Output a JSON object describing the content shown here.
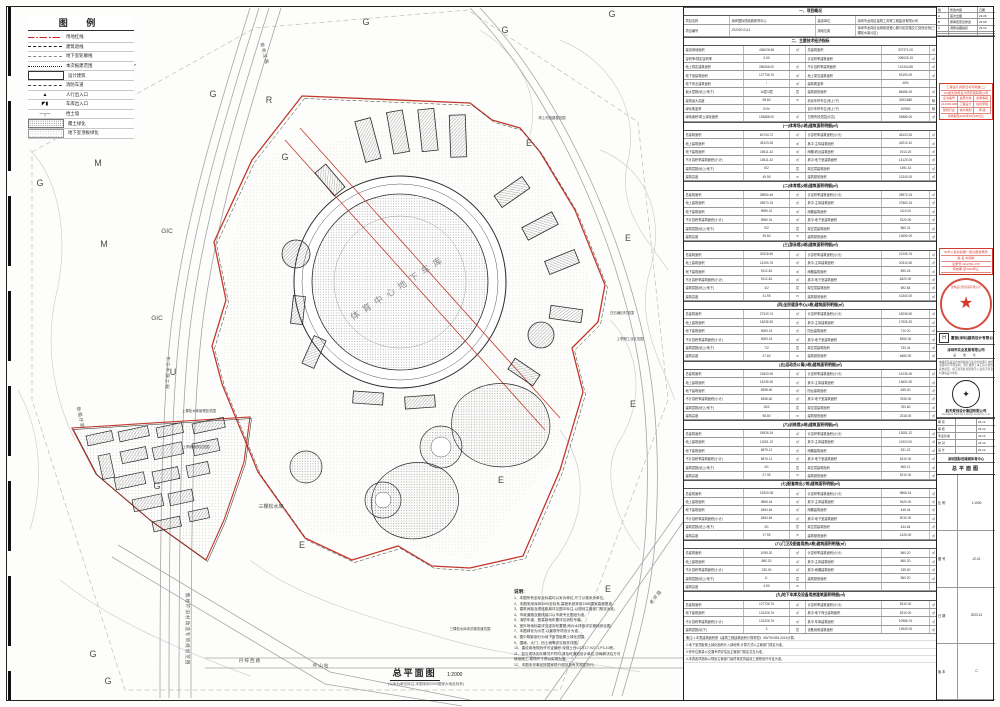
{
  "colors": {
    "red": "#c0392b",
    "stamp_red": "#d23a2e",
    "line_dark": "#2a2a2a",
    "line_gray": "#999999",
    "contour": "#c8c8c8"
  },
  "legend": {
    "title": "图  例",
    "items": [
      {
        "kind": "redline",
        "label": "用地红线"
      },
      {
        "kind": "dash",
        "label": "建筑退线"
      },
      {
        "kind": "graydash",
        "label": "地下室轮廓线"
      },
      {
        "kind": "dots",
        "label": "本次报建范围"
      },
      {
        "kind": "rect",
        "label": "设计建筑"
      },
      {
        "kind": "fire",
        "label": "消防车道"
      },
      {
        "kind": "glyph-ped",
        "label": "人行出入口"
      },
      {
        "kind": "glyph-car",
        "label": "车库出入口"
      },
      {
        "kind": "glyph-wall",
        "label": "挡土墙"
      },
      {
        "kind": "hatch",
        "label": "覆土绿化"
      },
      {
        "kind": "slab",
        "label": "地下室顶板绿化"
      }
    ]
  },
  "compass": {
    "label": "N"
  },
  "zones": [
    {
      "t": "G",
      "x": 40,
      "y": 186
    },
    {
      "t": "G",
      "x": 213,
      "y": 97
    },
    {
      "t": "G",
      "x": 285,
      "y": 160
    },
    {
      "t": "G",
      "x": 366,
      "y": 25
    },
    {
      "t": "G",
      "x": 505,
      "y": 33
    },
    {
      "t": "G",
      "x": 612,
      "y": 17
    },
    {
      "t": "G",
      "x": 157,
      "y": 489
    },
    {
      "t": "G",
      "x": 93,
      "y": 657
    },
    {
      "t": "G",
      "x": 108,
      "y": 684
    },
    {
      "t": "M",
      "x": 98,
      "y": 166
    },
    {
      "t": "M",
      "x": 104,
      "y": 247
    },
    {
      "t": "R",
      "x": 269,
      "y": 103
    },
    {
      "t": "U",
      "x": 173,
      "y": 375
    },
    {
      "t": "GIC",
      "x": 167,
      "y": 233
    },
    {
      "t": "GIC",
      "x": 157,
      "y": 320
    },
    {
      "t": "E",
      "x": 529,
      "y": 146
    },
    {
      "t": "E",
      "x": 628,
      "y": 241
    },
    {
      "t": "E",
      "x": 633,
      "y": 407
    },
    {
      "t": "E",
      "x": 302,
      "y": 548
    },
    {
      "t": "E",
      "x": 608,
      "y": 592
    },
    {
      "t": "E",
      "x": 501,
      "y": 483
    }
  ],
  "road_labels": [
    {
      "t": "新布龙路",
      "x": 263,
      "y": 54,
      "r": 76
    },
    {
      "t": "新围仔路",
      "x": 79,
      "y": 418,
      "r": 78
    },
    {
      "t": "东江水源工程",
      "x": 166,
      "y": 373,
      "r": 92
    },
    {
      "t": "俄地吓旧村改造专项规划范围",
      "x": 186,
      "y": 629,
      "r": 90
    },
    {
      "t": "丹梓西路",
      "x": 250,
      "y": 662,
      "r": 0
    },
    {
      "t": "坪山站",
      "x": 321,
      "y": 667,
      "r": 0
    },
    {
      "t": "老坪路",
      "x": 657,
      "y": 598,
      "r": -52
    }
  ],
  "plan_labels": [
    {
      "t": "三棵松水库",
      "x": 271,
      "y": 508,
      "s": 5
    },
    {
      "t": "上棵松水库管理处范围",
      "x": 199,
      "y": 412,
      "s": 3.4
    },
    {
      "t": "上李朗地铁站范围",
      "x": 196,
      "y": 448,
      "s": 3.4
    },
    {
      "t": "三棵松水库泄洪渠改道范围",
      "x": 470,
      "y": 630,
      "s": 3.4
    },
    {
      "t": "白石塘旧村范围",
      "x": 622,
      "y": 314,
      "s": 3.4
    },
    {
      "t": "上李朗工业区范围",
      "x": 630,
      "y": 340,
      "s": 3.4
    },
    {
      "t": "简上村统建楼范围",
      "x": 552,
      "y": 119,
      "s": 3.4
    }
  ],
  "center_label": {
    "t": "体育中心地下车库",
    "x": 400,
    "y": 290,
    "rot": -33
  },
  "plan_title": {
    "text": "总平面图",
    "scale": "1:2000",
    "caption": "(以米为单位标注,本图采用2000国家大地坐标系)"
  },
  "notes": {
    "title": "说明:",
    "items": [
      "1、本图所有坐标及标高均以米为单位,尺寸以毫米为单位。",
      "2、本图采用深圳2000坐标系,高程系统采用1985国家高程基准。",
      "3、建筑间距及退线距离详见图中标注,以规划主管部门核定为准。",
      "4、市政道路及管线接口以市政专业图纸为准。",
      "5、消防车道、登高场地布置详见消防专篇。",
      "6、室外场地标高详见竖向布置图,雨污水排放详见管线综合图。",
      "7、本图绿化为示意,以景观专项设计为准。",
      "8、图中阴影部分为地下室顶板覆土绿化范围。",
      "9、围墙、大门、挡土墙等详见相关详图。",
      "10、建设用地规划许可证编号:深规土许LG字17,927-1,P3-10栋。",
      "11、若与现场实际情况不符时,请及时通知设计单位,协商解决后方可",
      "      继续施工,现场尺寸须以实测为准。",
      "12、本图未尽事宜按国家现行规范及有关规定执行。"
    ]
  },
  "table": {
    "blocks": [
      {
        "h": "一、项目概况"
      },
      {
        "t": "info",
        "c": [
          "项目名称",
          "深圳国际低碳城体育中心",
          "建设单位",
          "深圳市龙岗区建筑工务署工程建设有限公司"
        ]
      },
      {
        "t": "info",
        "c": [
          "项目编号",
          "JS2020-0112",
          "用地位置",
          "深圳市龙岗区龙城街道爱心路与如意路交汇处西北侧(三棵松水库片区)"
        ]
      },
      {
        "h": "二、主要技术经济指标"
      },
      {
        "c": [
          "建设用地面积",
          "436026.98",
          "㎡",
          "总建筑面积",
          "337371.00",
          "㎡"
        ]
      },
      {
        "c": [
          "容积率/规定容积率",
          "0.60",
          "",
          "计容积率建筑面积",
          "206026.15",
          "㎡"
        ]
      },
      {
        "c": [
          "地上规定建筑面积",
          "265266.00",
          "㎡",
          "不计容积率建筑面积",
          "131344.85",
          "㎡"
        ]
      },
      {
        "c": [
          "地下室建筑面积",
          "127736.76",
          "㎡",
          "地上架空建筑面积",
          "53190.00",
          "㎡"
        ]
      },
      {
        "c": [
          "地下商业建筑面积",
          "/",
          "㎡",
          "建筑覆盖率",
          "46%",
          ""
        ]
      },
      {
        "c": [
          "最大层数(地上/地下)",
          "16层/3层",
          "层",
          "建筑基底面积",
          "84686.30",
          "㎡"
        ]
      },
      {
        "c": [
          "建筑最大高度",
          "98.80",
          "m",
          "机动车停车位(地上/下)",
          "325/2680",
          "辆"
        ]
      },
      {
        "c": [
          "绿化覆盖率",
          "51%",
          "",
          "自行车停车位(地上/下)",
          "1095/0",
          "辆"
        ]
      },
      {
        "c": [
          "绿地面积/覆土绿化面积",
          "153888.00",
          "㎡",
          "日照有效范围(示意)",
          "53888.00",
          "㎡"
        ]
      },
      {
        "h": "(一)体育场(1栋)建筑面积明细(㎡)"
      },
      {
        "c": [
          "总建筑面积",
          "60734.72",
          "㎡",
          "计容积率建筑面积(小计)",
          "45123.30",
          "㎡"
        ]
      },
      {
        "c": [
          "地上建筑面积",
          "45123.30",
          "㎡",
          "其中:主体建筑面积",
          "43210.10",
          "㎡"
        ]
      },
      {
        "c": [
          "地下建筑面积",
          "15611.42",
          "㎡",
          "雨棚/看台建筑面积",
          "1913.20",
          "㎡"
        ]
      },
      {
        "c": [
          "不计容积率建筑面积(小计)",
          "15611.42",
          "㎡",
          "其中:地下室建筑面积",
          "14120.00",
          "㎡"
        ]
      },
      {
        "c": [
          "建筑层数(地上/地下)",
          "6/2",
          "层",
          "架空层建筑面积",
          "1491.42",
          "㎡"
        ]
      },
      {
        "c": [
          "建筑高度",
          "49.95",
          "m",
          "建筑基底面积",
          "21340.00",
          "㎡"
        ]
      },
      {
        "h": "(二)体育馆(2栋)建筑面积明细(㎡)"
      },
      {
        "c": [
          "总建筑面积",
          "38950.46",
          "㎡",
          "计容积率建筑面积(小计)",
          "28970.15",
          "㎡"
        ]
      },
      {
        "c": [
          "地上建筑面积",
          "28970.15",
          "㎡",
          "其中:主体建筑面积",
          "27860.15",
          "㎡"
        ]
      },
      {
        "c": [
          "地下建筑面积",
          "9980.31",
          "㎡",
          "雨棚建筑面积",
          "1110.00",
          "㎡"
        ]
      },
      {
        "c": [
          "不计容积率建筑面积(小计)",
          "9980.31",
          "㎡",
          "其中:地下室建筑面积",
          "9120.00",
          "㎡"
        ]
      },
      {
        "c": [
          "建筑层数(地上/地下)",
          "5/2",
          "层",
          "架空层建筑面积",
          "860.31",
          "㎡"
        ]
      },
      {
        "c": [
          "建筑高度",
          "39.80",
          "m",
          "建筑基底面积",
          "12650.00",
          "㎡"
        ]
      },
      {
        "h": "(三)游泳馆(3栋)建筑面积明细(㎡)"
      },
      {
        "c": [
          "总建筑面积",
          "30318.60",
          "㎡",
          "计容积率建筑面积(小计)",
          "21205.76",
          "㎡"
        ]
      },
      {
        "c": [
          "地上建筑面积",
          "21205.76",
          "㎡",
          "其中:主体建筑面积",
          "20310.50",
          "㎡"
        ]
      },
      {
        "c": [
          "地下建筑面积",
          "9112.84",
          "㎡",
          "雨棚建筑面积",
          "895.26",
          "㎡"
        ]
      },
      {
        "c": [
          "不计容积率建筑面积(小计)",
          "9112.84",
          "㎡",
          "其中:地下室建筑面积",
          "8420.00",
          "㎡"
        ]
      },
      {
        "c": [
          "建筑层数(地上/地下)",
          "4/2",
          "层",
          "架空层建筑面积",
          "692.84",
          "㎡"
        ]
      },
      {
        "c": [
          "建筑高度",
          "31.95",
          "m",
          "建筑基底面积",
          "10240.00",
          "㎡"
        ]
      },
      {
        "h": "(四)全民健身中心(4栋)建筑面积明细(㎡)"
      },
      {
        "c": [
          "总建筑面积",
          "27319.74",
          "㎡",
          "计容积率建筑面积(小计)",
          "18236.50",
          "㎡"
        ]
      },
      {
        "c": [
          "地上建筑面积",
          "18236.50",
          "㎡",
          "其中:主体建筑面积",
          "17526.30",
          "㎡"
        ]
      },
      {
        "c": [
          "地下建筑面积",
          "9083.24",
          "㎡",
          "阳台建筑面积",
          "710.20",
          "㎡"
        ]
      },
      {
        "c": [
          "不计容积率建筑面积(小计)",
          "9083.24",
          "㎡",
          "其中:地下室建筑面积",
          "8350.00",
          "㎡"
        ]
      },
      {
        "c": [
          "建筑层数(地上/地下)",
          "7/2",
          "层",
          "架空层建筑面积",
          "733.24",
          "㎡"
        ]
      },
      {
        "c": [
          "建筑高度",
          "47.60",
          "m",
          "建筑基底面积",
          "6480.00",
          "㎡"
        ]
      },
      {
        "h": "(五)运动员公寓(5栋)建筑面积明细(㎡)"
      },
      {
        "c": [
          "总建筑面积",
          "22633.90",
          "㎡",
          "计容积率建筑面积(小计)",
          "14235.30",
          "㎡"
        ]
      },
      {
        "c": [
          "地上建筑面积",
          "14235.30",
          "㎡",
          "其中:主体建筑面积",
          "13600.30",
          "㎡"
        ]
      },
      {
        "c": [
          "地下建筑面积",
          "8398.60",
          "㎡",
          "阳台建筑面积",
          "635.00",
          "㎡"
        ]
      },
      {
        "c": [
          "不计容积率建筑面积(小计)",
          "8398.60",
          "㎡",
          "其中:地下室建筑面积",
          "7635.00",
          "㎡"
        ]
      },
      {
        "c": [
          "建筑层数(地上/地下)",
          "16/2",
          "层",
          "架空层建筑面积",
          "763.60",
          "㎡"
        ]
      },
      {
        "c": [
          "建筑高度",
          "98.80",
          "m",
          "建筑基底面积",
          "2318.00",
          "㎡"
        ]
      },
      {
        "h": "(六)训练馆(6栋)建筑面积明细(㎡)"
      },
      {
        "c": [
          "总建筑面积",
          "18926.34",
          "㎡",
          "计容积率建筑面积(小计)",
          "12051.22",
          "㎡"
        ]
      },
      {
        "c": [
          "地上建筑面积",
          "12051.22",
          "㎡",
          "其中:主体建筑面积",
          "11520.00",
          "㎡"
        ]
      },
      {
        "c": [
          "地下建筑面积",
          "6875.12",
          "㎡",
          "雨棚建筑面积",
          "531.22",
          "㎡"
        ]
      },
      {
        "c": [
          "不计容积率建筑面积(小计)",
          "6875.12",
          "㎡",
          "其中:地下室建筑面积",
          "6310.00",
          "㎡"
        ]
      },
      {
        "c": [
          "建筑层数(地上/地下)",
          "4/1",
          "层",
          "架空层建筑面积",
          "565.12",
          "㎡"
        ]
      },
      {
        "c": [
          "建筑高度",
          "27.35",
          "m",
          "建筑基底面积",
          "5210.00",
          "㎡"
        ]
      },
      {
        "h": "(七)配套商业(7栋)建筑面积明细(㎡)"
      },
      {
        "c": [
          "总建筑面积",
          "15320.08",
          "㎡",
          "计容积率建筑面积(小计)",
          "9865.44",
          "㎡"
        ]
      },
      {
        "c": [
          "地上建筑面积",
          "9865.44",
          "㎡",
          "其中:主体建筑面积",
          "9420.00",
          "㎡"
        ]
      },
      {
        "c": [
          "地下建筑面积",
          "5454.64",
          "㎡",
          "雨棚建筑面积",
          "445.44",
          "㎡"
        ]
      },
      {
        "c": [
          "不计容积率建筑面积(小计)",
          "5454.64",
          "㎡",
          "其中:地下室建筑面积",
          "5010.00",
          "㎡"
        ]
      },
      {
        "c": [
          "建筑层数(地上/地下)",
          "3/1",
          "层",
          "架空层建筑面积",
          "444.64",
          "㎡"
        ]
      },
      {
        "c": [
          "建筑高度",
          "17.95",
          "m",
          "建筑基底面积",
          "4126.00",
          "㎡"
        ]
      },
      {
        "h": "(八)门卫及配套用房(8栋)建筑面积明细(㎡)"
      },
      {
        "c": [
          "总建筑面积",
          "1095.20",
          "㎡",
          "计容积率建筑面积(小计)",
          "860.20",
          "㎡"
        ]
      },
      {
        "c": [
          "地上建筑面积",
          "860.20",
          "㎡",
          "其中:主体建筑面积",
          "860.20",
          "㎡"
        ]
      },
      {
        "c": [
          "不计容积率建筑面积(小计)",
          "235.00",
          "㎡",
          "其中:雨棚建筑面积",
          "235.00",
          "㎡"
        ]
      },
      {
        "c": [
          "建筑层数(地上/地下)",
          "1/-",
          "层",
          "建筑基底面积",
          "860.20",
          "㎡"
        ]
      },
      {
        "c": [
          "建筑高度",
          "4.50",
          "m",
          "",
          "",
          ""
        ]
      },
      {
        "h": "(九)地下车库及设备用房建筑面积明细(㎡)"
      },
      {
        "c": [
          "总建筑面积",
          "127736.76",
          "㎡",
          "计容积率建筑面积(小计)",
          "5310.00",
          "㎡"
        ]
      },
      {
        "c": [
          "地下建筑面积",
          "122426.76",
          "㎡",
          "其中:地下商业建筑面积",
          "5310.00",
          "㎡"
        ]
      },
      {
        "c": [
          "不计容积率建筑面积(小计)",
          "122426.76",
          "㎡",
          "其中:车库建筑面积",
          "10986.76",
          "㎡"
        ]
      },
      {
        "c": [
          "建筑层数(地下)",
          "3",
          "层",
          "设备用房建筑面积",
          "12540.00",
          "㎡"
        ]
      },
      {
        "t": "tail",
        "c": "备注:1.本表建筑面积按《建筑工程建筑面积计算规范》GB/T50353-2013计算。"
      },
      {
        "t": "tail",
        "c": "2.地下室顶板覆土绿化面积计入绿地率,计算方式以主管部门核定为准。"
      },
      {
        "t": "tail",
        "c": "3.停车位数量以交通专项评估及主管部门核定意见为准。"
      },
      {
        "t": "tail",
        "c": "4.本表各项指标以规划主管部门最终核发的建设工程规划许可证为准。"
      }
    ]
  },
  "strip": {
    "revisions": {
      "rows": [
        [
          "版",
          "修改内容",
          "日期"
        ],
        [
          "A",
          "首次出图",
          "23.06"
        ],
        [
          "B",
          "按审查意见修改",
          "23.09"
        ],
        [
          "C",
          "调整总图指标",
          "23.12"
        ],
        [
          "",
          "",
          ""
        ],
        [
          "",
          "",
          ""
        ]
      ]
    },
    "stamp1": {
      "line1": "工程设计资质证书专用章(二)",
      "line2": "XX航天建筑设计研究院有限公司",
      "grid": [
        [
          "证书编号",
          "资质分类",
          "资质等级"
        ],
        [
          "A144001966",
          "工程设计",
          "综合甲级"
        ],
        [
          "建筑行业",
          "城乡规划",
          "甲  级"
        ]
      ],
      "valid": "有效期至2025年06月30日止"
    },
    "stamp2": {
      "title": "中华人民共和国一级注册建筑师",
      "rows": [
        [
          "姓  名",
          "刘如昕"
        ],
        [
          "注册号",
          "1112301-076"
        ],
        [
          "有效期",
          "至2025年止"
        ]
      ]
    },
    "seal": {
      "arc": "建筑设计研究院有限公司",
      "star": "★"
    },
    "firm": {
      "logo": "H",
      "name": "霍普(深圳)建筑设计有限公司"
    },
    "owner": {
      "name": "深圳市实业发展有限公司",
      "sub": "盖 章 处"
    },
    "disclaimer": "本图纸及其设计内容版权归设计单位所有,未经书面许可不得复制、转让或用于本工程以外的其他项目。施工前须核对现场尺寸,如有不符及时通知设计单位。",
    "emblem": {
      "glyph": "✦"
    },
    "group": {
      "name": "航天规划设计集团有限公司",
      "en": "Aerospace Planning & Design Group Co., Ltd."
    },
    "sign": {
      "rows": [
        [
          "审 定",
          "",
          "23.12"
        ],
        [
          "审 核",
          "",
          "23.12"
        ],
        [
          "专业负责",
          "",
          "23.12"
        ],
        [
          "校 对",
          "",
          "23.12"
        ],
        [
          "设 计",
          "",
          "23.12"
        ]
      ]
    },
    "project": {
      "name": "深圳国际低碳城体育中心"
    },
    "drawing": {
      "name": "总平面图"
    },
    "bottom": {
      "rows": [
        [
          "比 例",
          "1:1000"
        ],
        [
          "图 号",
          "JZ-01"
        ],
        [
          "日 期",
          "2023.12"
        ],
        [
          "版 本",
          "C"
        ]
      ]
    }
  }
}
